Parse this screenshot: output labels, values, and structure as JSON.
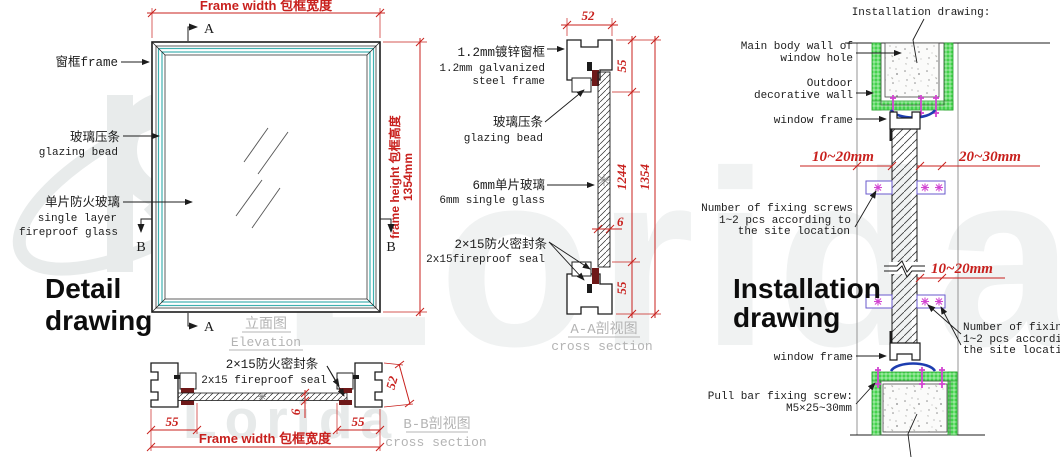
{
  "watermark": {
    "brand": "Lorida"
  },
  "colors": {
    "dim_red": "#c8201d",
    "glazing_teal": "#3fb0b0",
    "wall_green": "#42d24b",
    "screw_magenta": "#d246d2",
    "seal_blue": "#1d3db0",
    "seal_maroon": "#6e1818",
    "caption_gray": "#b4b4b4"
  },
  "detail": {
    "title_line1": "Detail",
    "title_line2": "drawing",
    "dim_frame_width": "Frame width 包框宽度",
    "dim_frame_height": "frame height 包框高度",
    "dim_frame_height_value": "1354mm",
    "marker_a_top": "A",
    "marker_a_bottom": "A",
    "marker_b_left": "B",
    "marker_b_right": "B",
    "label_frame": "窗框frame",
    "label_glazing_cn": "玻璃压条",
    "label_glazing_en": "glazing bead",
    "label_glass_cn": "单片防火玻璃",
    "label_glass_en1": "single layer",
    "label_glass_en2": "fireproof glass",
    "caption_cn": "立面图",
    "caption_en": "Elevation"
  },
  "section_aa": {
    "dim_52": "52",
    "dim_55_top": "55",
    "dim_1244": "1244",
    "dim_1354": "1354",
    "dim_6": "6",
    "dim_55_bottom": "55",
    "label_steel_cn": "1.2mm镀锌窗框",
    "label_steel_en1": "1.2mm galvanized",
    "label_steel_en2": "steel frame",
    "label_glazing_cn": "玻璃压条",
    "label_glazing_en": "glazing bead",
    "label_glass_cn": "6mm单片玻璃",
    "label_glass_en": "6mm single glass",
    "label_seal_cn": "2×15防火密封条",
    "label_seal_en": "2x15fireproof seal",
    "caption_cn": "A-A剖视图",
    "caption_en": "cross section"
  },
  "section_bb": {
    "label_seal_cn": "2×15防火密封条",
    "label_seal_en": "2x15 fireproof seal",
    "dim_55_left": "55",
    "dim_55_right": "55",
    "dim_6": "6",
    "dim_52": "52",
    "dim_frame_width": "Frame width 包框宽度",
    "caption_cn": "B-B剖视图",
    "caption_en": "cross section"
  },
  "installation": {
    "header": "Installation drawing:",
    "title_line1": "Installation",
    "title_line2": "drawing",
    "label_wall_a1": "Main body wall of",
    "label_wall_a2": "window hole",
    "label_wall_b1": "Outdoor",
    "label_wall_b2": "decorative wall",
    "label_window_frame_top": "window frame",
    "label_window_frame_bottom": "window frame",
    "dim_gap_left": "10~20mm",
    "dim_gap_right": "20~30mm",
    "dim_gap_lower": "10~20mm",
    "screws_left_1": "Number of fixing screws",
    "screws_left_2": "1~2 pcs according to",
    "screws_left_3": "the site location",
    "screws_right_1": "Number of fixing screws",
    "screws_right_2": "1~2 pcs according to",
    "screws_right_3": "the site location",
    "pull_bar_1": "Pull bar fixing screw:",
    "pull_bar_2": "M5×25~30mm"
  }
}
